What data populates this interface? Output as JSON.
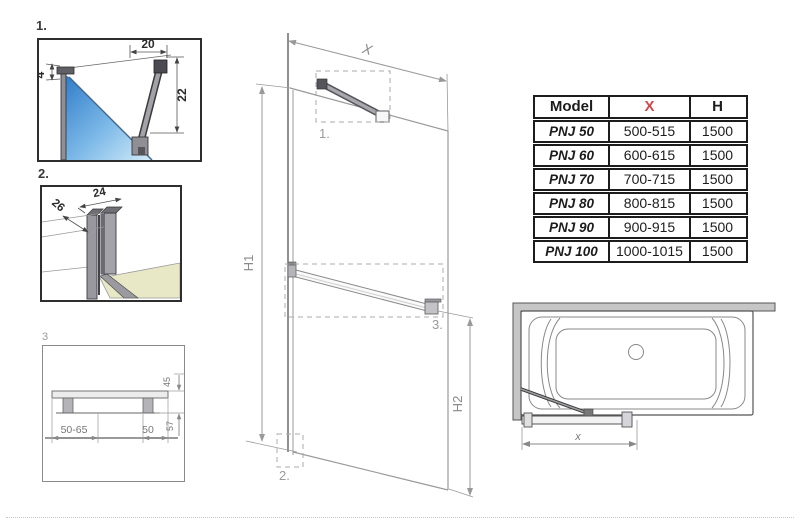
{
  "colors": {
    "accent_red": "#cf4a4a",
    "line_dark": "#3a3a3a",
    "line_light": "#9a9a9a",
    "glass_blue_dark": "#2d7ac9",
    "glass_blue_light": "#d3ebf9",
    "metal_gray": "#9a9aa0",
    "floor_beige": "#e8e8c6",
    "wall_gray": "#c6c6c6"
  },
  "details": {
    "d1": {
      "label": "1.",
      "dim_top": "20",
      "dim_right": "22",
      "dim_left": "4"
    },
    "d2": {
      "label": "2.",
      "dim_width": "24",
      "dim_depth": "26"
    },
    "d3": {
      "label": "3",
      "dim_span": "50-65",
      "dim_offset": "50",
      "dim_upper": "45",
      "dim_lower": "57"
    }
  },
  "main": {
    "dim_width": "X",
    "dim_h1": "H1",
    "dim_h2": "H2",
    "callout_1": "1.",
    "callout_2": "2.",
    "callout_3": "3."
  },
  "tub": {
    "dim_x": "x"
  },
  "table": {
    "headers": {
      "model": "Model",
      "x": "X",
      "h": "H"
    },
    "x_header_style": "color:#cf4a4a",
    "rows": [
      {
        "model": "PNJ 50",
        "x": "500-515",
        "h": "1500"
      },
      {
        "model": "PNJ 60",
        "x": "600-615",
        "h": "1500"
      },
      {
        "model": "PNJ 70",
        "x": "700-715",
        "h": "1500"
      },
      {
        "model": "PNJ 80",
        "x": "800-815",
        "h": "1500"
      },
      {
        "model": "PNJ 90",
        "x": "900-915",
        "h": "1500"
      },
      {
        "model": "PNJ 100",
        "x": "1000-1015",
        "h": "1500"
      }
    ]
  }
}
